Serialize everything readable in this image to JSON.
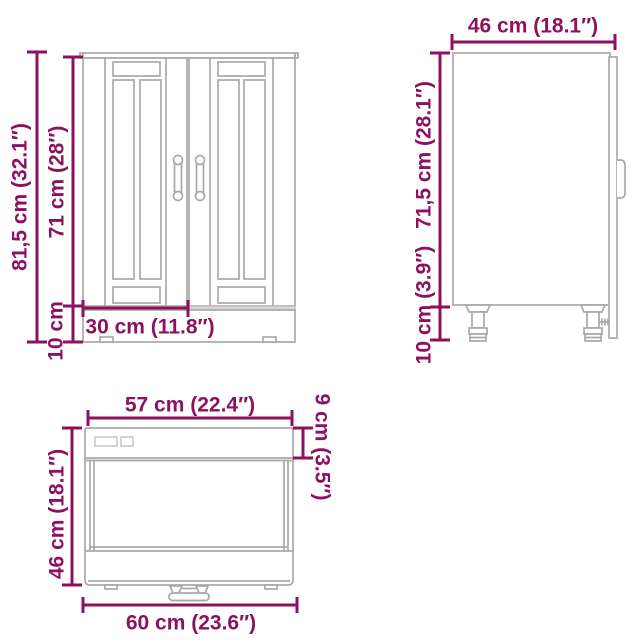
{
  "colors": {
    "accent_dimension": "#8D115E",
    "drawing_line": "#a9a9a9",
    "background": "#ffffff"
  },
  "views": {
    "front": {
      "labels": {
        "total_height": "81,5 cm (32.1″)",
        "door_height": "71 cm (28″)",
        "plinth_height": "10 cm",
        "door_width": "30 cm (11.8″)"
      }
    },
    "side": {
      "labels": {
        "depth": "46 cm (18.1″)",
        "body_height": "71,5 cm (28.1″)",
        "leg_height": "10 cm (3.9″)"
      }
    },
    "top": {
      "labels": {
        "body_width": "57 cm (22.4″)",
        "door_offset_depth": "9 cm (3.5″)",
        "depth": "46 cm (18.1″)",
        "total_width": "60 cm (23.6″)"
      }
    }
  }
}
